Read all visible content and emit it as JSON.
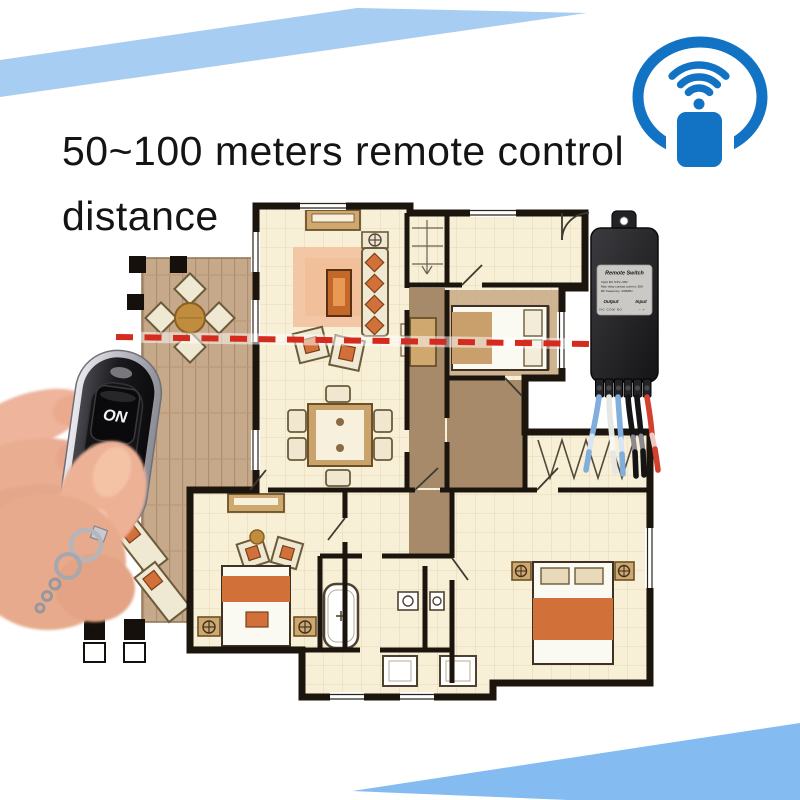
{
  "title": {
    "line1": "50~100 meters remote control",
    "line2": "distance"
  },
  "wifi_icon": {
    "name": "wifi-remote-signal-icon"
  },
  "remote": {
    "on": "ON",
    "off": "OFF"
  },
  "module": {
    "title": "Remote Switch",
    "spec1": "Input DC 5.5V~28V",
    "spec2": "Max relay contact current: 30A",
    "spec3": "RF frequency: 433MHz",
    "output": "Output",
    "input": "Input",
    "output_terminals": "NC  COM  NO",
    "input_terminals": "−    +",
    "wire_colors": [
      "blue",
      "white",
      "blue",
      "black",
      "black",
      "red"
    ]
  },
  "signal": {
    "style": "red-dashed-line from remote to switch module"
  },
  "colors": {
    "banner_top": "#a7cdf2",
    "banner_bottom": "#84bcf1",
    "wifi_blue": "#1272c3",
    "signal_red": "#d42b1e",
    "plan_cream": "#f7efd6",
    "plan_wall": "#1b150e",
    "deck_tan": "#c6a98a",
    "hall_brown": "#a68a6a",
    "accent_orange": "#d2703a"
  }
}
